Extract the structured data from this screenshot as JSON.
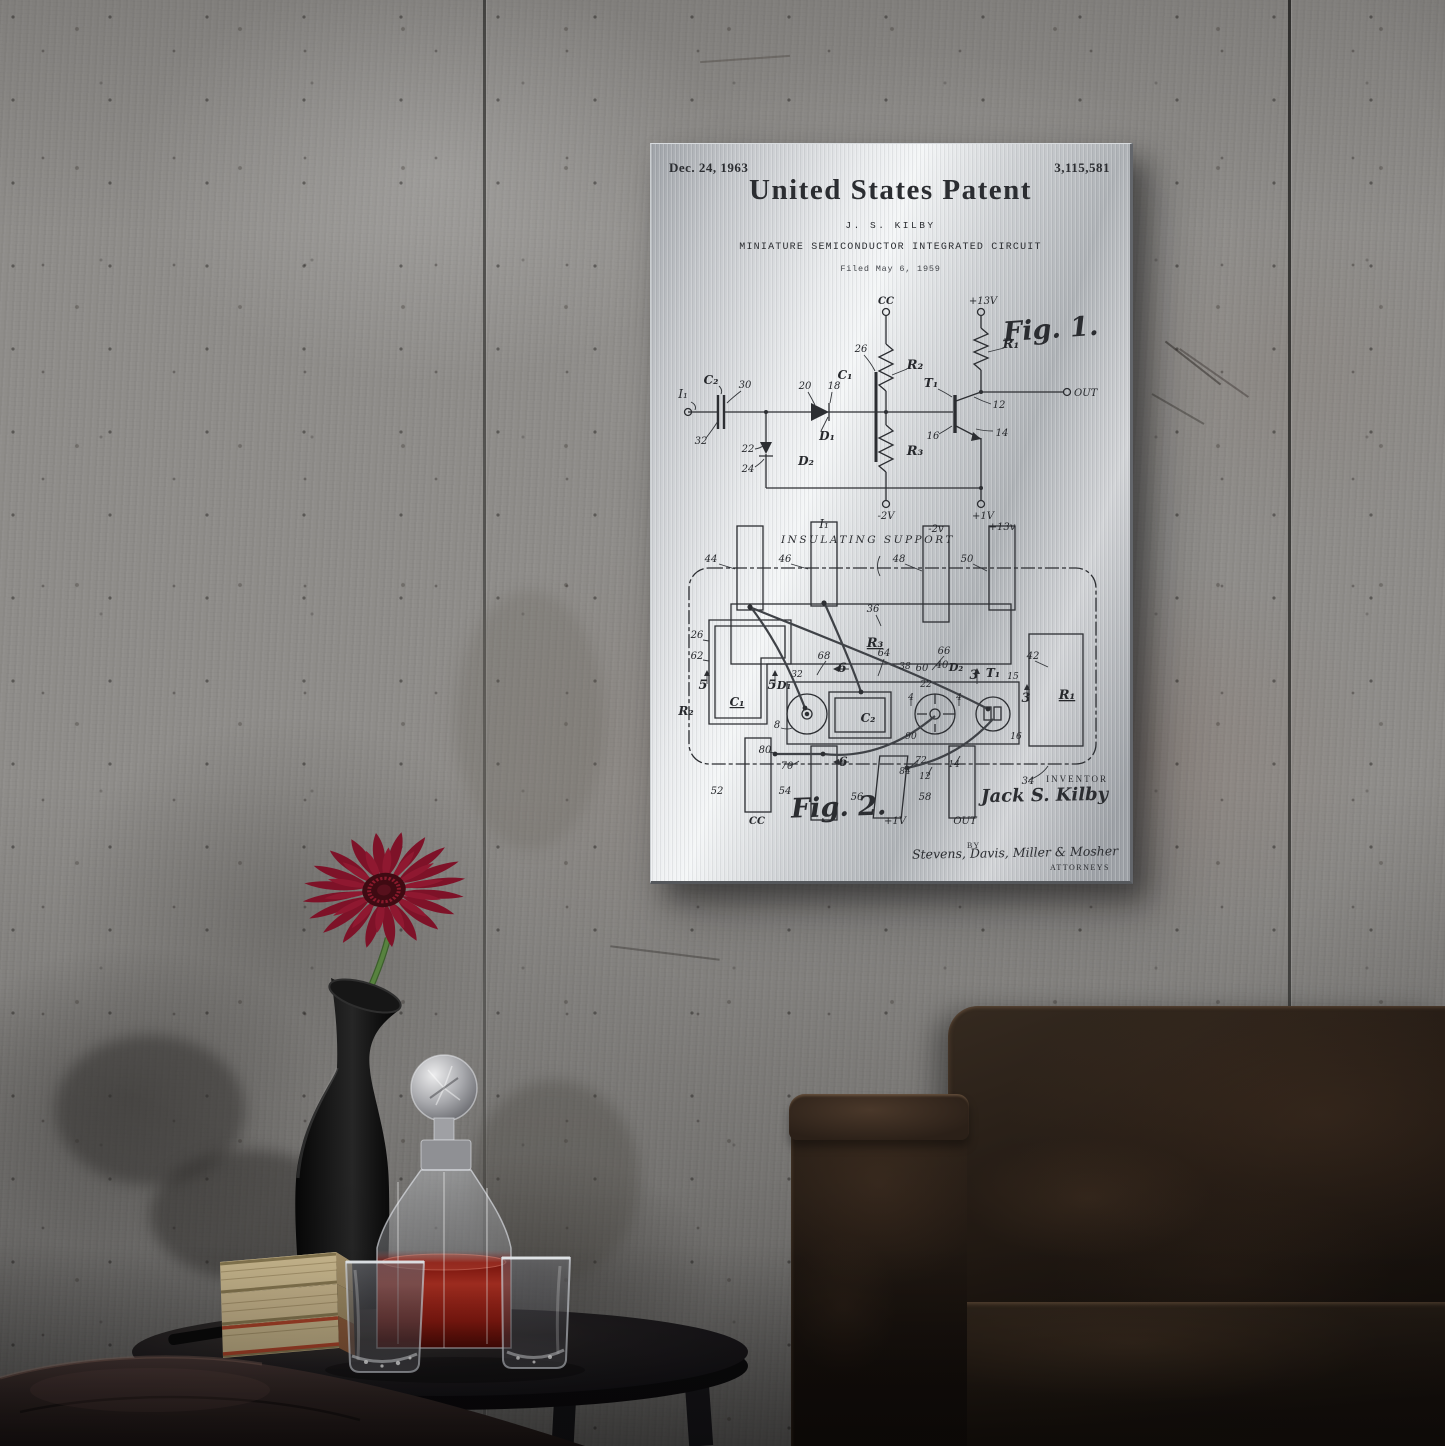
{
  "print": {
    "date": "Dec. 24, 1963",
    "number": "3,115,581",
    "title": "United States Patent",
    "inventor_line": "J. S. KILBY",
    "subject": "MINIATURE SEMICONDUCTOR INTEGRATED CIRCUIT",
    "filed": "Filed May 6, 1959",
    "fig1": {
      "caption": "Fig. 1.",
      "labels": [
        {
          "t": "CC",
          "x": 215,
          "y": 12,
          "it": 1,
          "b": 1
        },
        {
          "t": "+13V",
          "x": 312,
          "y": 12,
          "it": 1
        },
        {
          "t": "I₁",
          "x": 12,
          "y": 106,
          "it": 1,
          "fs": 12
        },
        {
          "t": "C₂",
          "x": 40,
          "y": 92,
          "it": 1,
          "b": 1,
          "fs": 12
        },
        {
          "t": "30",
          "x": 74,
          "y": 96,
          "it": 1
        },
        {
          "t": "32",
          "x": 30,
          "y": 152,
          "it": 1
        },
        {
          "t": "20",
          "x": 134,
          "y": 97,
          "it": 1
        },
        {
          "t": "18",
          "x": 163,
          "y": 97,
          "it": 1
        },
        {
          "t": "D₁",
          "x": 156,
          "y": 148,
          "it": 1,
          "b": 1,
          "fs": 12
        },
        {
          "t": "22",
          "x": 77,
          "y": 160,
          "it": 1
        },
        {
          "t": "24",
          "x": 77,
          "y": 180,
          "it": 1
        },
        {
          "t": "D₂",
          "x": 135,
          "y": 173,
          "it": 1,
          "b": 1,
          "fs": 12
        },
        {
          "t": "26",
          "x": 190,
          "y": 60,
          "it": 1
        },
        {
          "t": "C₁",
          "x": 174,
          "y": 87,
          "it": 1,
          "b": 1,
          "fs": 12
        },
        {
          "t": "R₂",
          "x": 244,
          "y": 77,
          "it": 1,
          "b": 1,
          "fs": 13
        },
        {
          "t": "R₃",
          "x": 244,
          "y": 163,
          "it": 1,
          "b": 1,
          "fs": 13
        },
        {
          "t": "R₁",
          "x": 340,
          "y": 56,
          "it": 1,
          "b": 1,
          "fs": 13
        },
        {
          "t": "T₁",
          "x": 260,
          "y": 95,
          "it": 1,
          "b": 1,
          "fs": 12
        },
        {
          "t": "12",
          "x": 328,
          "y": 116,
          "it": 1
        },
        {
          "t": "14",
          "x": 331,
          "y": 144,
          "it": 1
        },
        {
          "t": "16",
          "x": 262,
          "y": 147,
          "it": 1
        },
        {
          "t": "OUT",
          "x": 403,
          "y": 104,
          "it": 1,
          "fs": 10,
          "anchor": "start"
        },
        {
          "t": "-2V",
          "x": 215,
          "y": 227,
          "it": 1
        },
        {
          "t": "+1V",
          "x": 312,
          "y": 227,
          "it": 1
        }
      ]
    },
    "fig2": {
      "caption": "Fig. 2.",
      "support": "INSULATING SUPPORT",
      "labels": [
        {
          "t": "I₁",
          "x": 153,
          "y": 12,
          "it": 1,
          "fs": 12
        },
        {
          "t": "-2v",
          "x": 265,
          "y": 16,
          "it": 1
        },
        {
          "t": "+13v",
          "x": 331,
          "y": 14,
          "it": 1
        },
        {
          "t": "44",
          "x": 40,
          "y": 46,
          "it": 1
        },
        {
          "t": "46",
          "x": 114,
          "y": 46,
          "it": 1
        },
        {
          "t": "48",
          "x": 228,
          "y": 46,
          "it": 1
        },
        {
          "t": "50",
          "x": 296,
          "y": 46,
          "it": 1
        },
        {
          "t": "36",
          "x": 202,
          "y": 96,
          "it": 1
        },
        {
          "t": "R₃",
          "x": 204,
          "y": 131,
          "it": 1,
          "b": 1,
          "fs": 13,
          "ul": 1
        },
        {
          "t": "26",
          "x": 26,
          "y": 122,
          "it": 1
        },
        {
          "t": "62",
          "x": 26,
          "y": 143,
          "it": 1
        },
        {
          "t": "5",
          "x": 32,
          "y": 173,
          "it": 1,
          "b": 1,
          "fs": 13
        },
        {
          "t": "5",
          "x": 101,
          "y": 173,
          "it": 1,
          "b": 1,
          "fs": 13
        },
        {
          "t": "C₁",
          "x": 66,
          "y": 190,
          "it": 1,
          "b": 1,
          "fs": 12,
          "ul": 1
        },
        {
          "t": "R₂",
          "x": 15,
          "y": 199,
          "it": 1,
          "b": 1,
          "fs": 12
        },
        {
          "t": "D₁",
          "x": 113,
          "y": 173,
          "it": 1,
          "b": 1,
          "fs": 11
        },
        {
          "t": "8",
          "x": 106,
          "y": 212,
          "it": 1
        },
        {
          "t": "32",
          "x": 126,
          "y": 161,
          "it": 1,
          "fs": 9
        },
        {
          "t": "68",
          "x": 153,
          "y": 143,
          "it": 1
        },
        {
          "t": "64",
          "x": 213,
          "y": 140,
          "it": 1
        },
        {
          "t": "6",
          "x": 171,
          "y": 156,
          "it": 1,
          "b": 1,
          "fs": 13
        },
        {
          "t": "C₂",
          "x": 197,
          "y": 206,
          "it": 1,
          "b": 1,
          "fs": 12
        },
        {
          "t": "38",
          "x": 234,
          "y": 153,
          "it": 1,
          "fs": 9
        },
        {
          "t": "60",
          "x": 251,
          "y": 155,
          "it": 1
        },
        {
          "t": "40",
          "x": 271,
          "y": 152,
          "it": 1
        },
        {
          "t": "D₂",
          "x": 285,
          "y": 155,
          "it": 1,
          "b": 1,
          "fs": 11
        },
        {
          "t": "22",
          "x": 255,
          "y": 171,
          "it": 1,
          "fs": 9
        },
        {
          "t": "4",
          "x": 240,
          "y": 184,
          "it": 1,
          "fs": 9
        },
        {
          "t": "4",
          "x": 288,
          "y": 184,
          "it": 1,
          "fs": 9
        },
        {
          "t": "90",
          "x": 240,
          "y": 223,
          "it": 1,
          "fs": 9
        },
        {
          "t": "3",
          "x": 303,
          "y": 163,
          "it": 1,
          "b": 1,
          "fs": 13
        },
        {
          "t": "T₁",
          "x": 322,
          "y": 161,
          "it": 1,
          "b": 1,
          "fs": 12
        },
        {
          "t": "15",
          "x": 342,
          "y": 163,
          "it": 1,
          "fs": 9
        },
        {
          "t": "3",
          "x": 355,
          "y": 186,
          "it": 1,
          "b": 1,
          "fs": 13
        },
        {
          "t": "16",
          "x": 345,
          "y": 223,
          "it": 1,
          "fs": 9
        },
        {
          "t": "66",
          "x": 273,
          "y": 138,
          "it": 1
        },
        {
          "t": "42",
          "x": 362,
          "y": 143,
          "it": 1
        },
        {
          "t": "R₁",
          "x": 396,
          "y": 183,
          "it": 1,
          "b": 1,
          "fs": 13,
          "ul": 1
        },
        {
          "t": "80",
          "x": 94,
          "y": 237,
          "it": 1
        },
        {
          "t": "70",
          "x": 116,
          "y": 253,
          "it": 1
        },
        {
          "t": "6",
          "x": 172,
          "y": 250,
          "it": 1,
          "b": 1,
          "fs": 13
        },
        {
          "t": "84",
          "x": 234,
          "y": 258,
          "it": 1,
          "fs": 9
        },
        {
          "t": "72",
          "x": 250,
          "y": 247,
          "it": 1,
          "fs": 9
        },
        {
          "t": "12",
          "x": 254,
          "y": 263,
          "it": 1,
          "fs": 9
        },
        {
          "t": "14",
          "x": 283,
          "y": 251,
          "it": 1,
          "fs": 9
        },
        {
          "t": "52",
          "x": 46,
          "y": 278,
          "it": 1
        },
        {
          "t": "54",
          "x": 114,
          "y": 278,
          "it": 1
        },
        {
          "t": "56",
          "x": 186,
          "y": 284,
          "it": 1
        },
        {
          "t": "58",
          "x": 254,
          "y": 284,
          "it": 1
        },
        {
          "t": "34",
          "x": 357,
          "y": 268,
          "it": 1
        },
        {
          "t": "CC",
          "x": 86,
          "y": 308,
          "it": 1,
          "b": 1
        },
        {
          "t": "+1V",
          "x": 224,
          "y": 308,
          "it": 1
        },
        {
          "t": "OUT",
          "x": 294,
          "y": 308,
          "it": 1,
          "fs": 10
        }
      ]
    },
    "sig": {
      "inventor_cap": "INVENTOR",
      "inventor": "Jack S. Kilby",
      "by": "BY",
      "attorneys": "Stevens, Davis, Miller & Mosher",
      "attorneys_cap": "ATTORNEYS"
    }
  },
  "colors": {
    "wall_grey": "#8f8d8a",
    "metal_light": "#f4f6f7",
    "metal_dark": "#9da1a6",
    "ink": "#2b2d31",
    "flower_red": "#b52a44",
    "flower_center": "#3f0a12",
    "stem_green": "#4e7a3a",
    "vase_black": "#141414",
    "liquid_red": "#a81e12",
    "book_pages": "#cfbd92",
    "book_red_edge": "#b0452a",
    "table_black": "#18161a",
    "ottoman_brown": "#382b28",
    "chair_leather": "#241b15"
  }
}
